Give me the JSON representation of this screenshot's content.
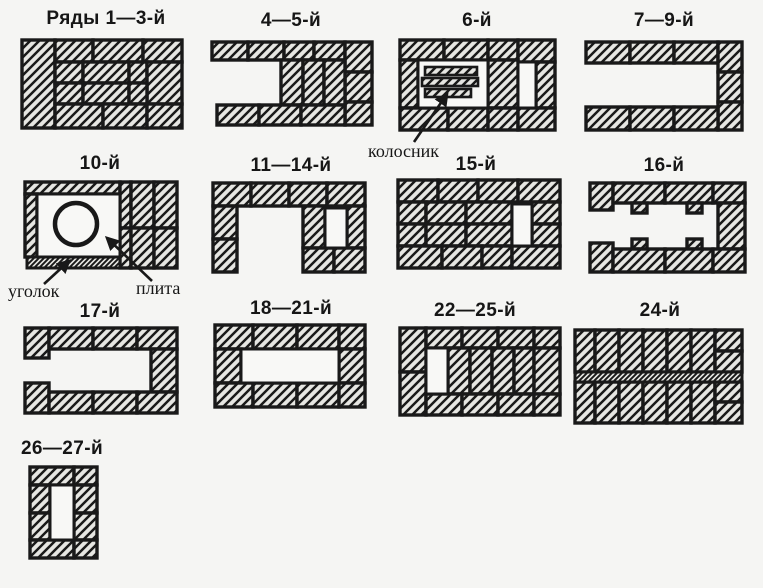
{
  "colors": {
    "background": "#f5f5f3",
    "ink": "#191919",
    "brick_fill": "#e6e6e2",
    "opening_fill": "#f8f8f6"
  },
  "diagrams": [
    {
      "id": "1-3",
      "title": "Ряды 1—3-й"
    },
    {
      "id": "4-5",
      "title": "4—5-й"
    },
    {
      "id": "6",
      "title": "6-й"
    },
    {
      "id": "7-9",
      "title": "7—9-й"
    },
    {
      "id": "10",
      "title": "10-й"
    },
    {
      "id": "11-14",
      "title": "11—14-й"
    },
    {
      "id": "15",
      "title": "15-й"
    },
    {
      "id": "16",
      "title": "16-й"
    },
    {
      "id": "17",
      "title": "17-й"
    },
    {
      "id": "18-21",
      "title": "18—21-й"
    },
    {
      "id": "22-25",
      "title": "22—25-й"
    },
    {
      "id": "24",
      "title": "24-й"
    },
    {
      "id": "26-27",
      "title": "26—27-й"
    }
  ],
  "annotations": [
    {
      "id": "grate",
      "text": "колосник"
    },
    {
      "id": "angle",
      "text": "уголок"
    },
    {
      "id": "plate",
      "text": "плита"
    }
  ]
}
